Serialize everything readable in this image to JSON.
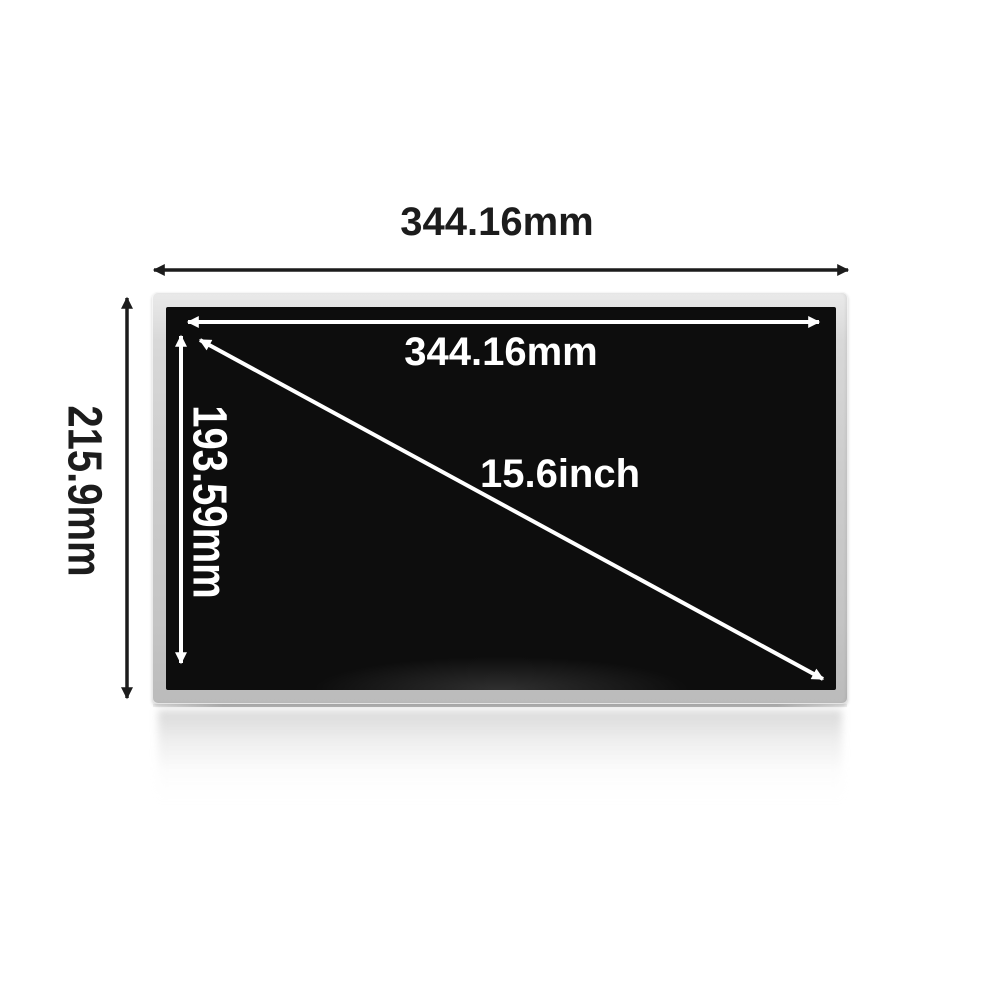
{
  "labels": {
    "outer_width": "344.16mm",
    "outer_height": "215.9mm",
    "active_width": "344.16mm",
    "active_height": "193.59mm",
    "diagonal": "15.6inch"
  },
  "colors": {
    "background": "#ffffff",
    "bezel": "#c9c9c9",
    "screen": "#0d0d0d",
    "outer_dimension_color": "#1c1c1c",
    "inner_dimension_color": "#ffffff"
  }
}
